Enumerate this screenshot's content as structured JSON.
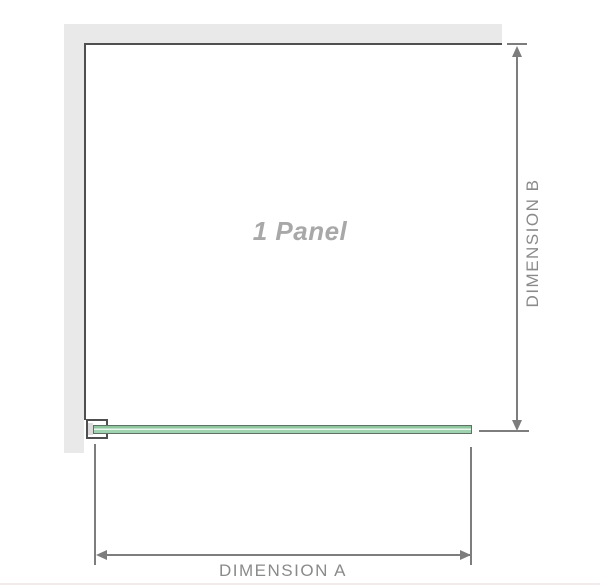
{
  "diagram": {
    "panel_label": "1 Panel",
    "dimension_a_label": "DIMENSION A",
    "dimension_b_label": "DIMENSION B",
    "colors": {
      "wall_fill": "#e9e9e9",
      "wall_edge_line": "#4f4f4f",
      "dimension_line": "#7d7d7d",
      "dimension_text": "#8a8a8a",
      "panel_label_text": "#a8a8a8",
      "glass_green": "#8ec69e",
      "glass_green_light": "#9fd2ae",
      "glass_highlight": "#eaf6ed",
      "glass_outline": "#5f7165",
      "bracket_outline": "#4f4f4f",
      "bracket_pad": "#dcdcdc",
      "bottom_rule": "#f0eae8"
    }
  }
}
